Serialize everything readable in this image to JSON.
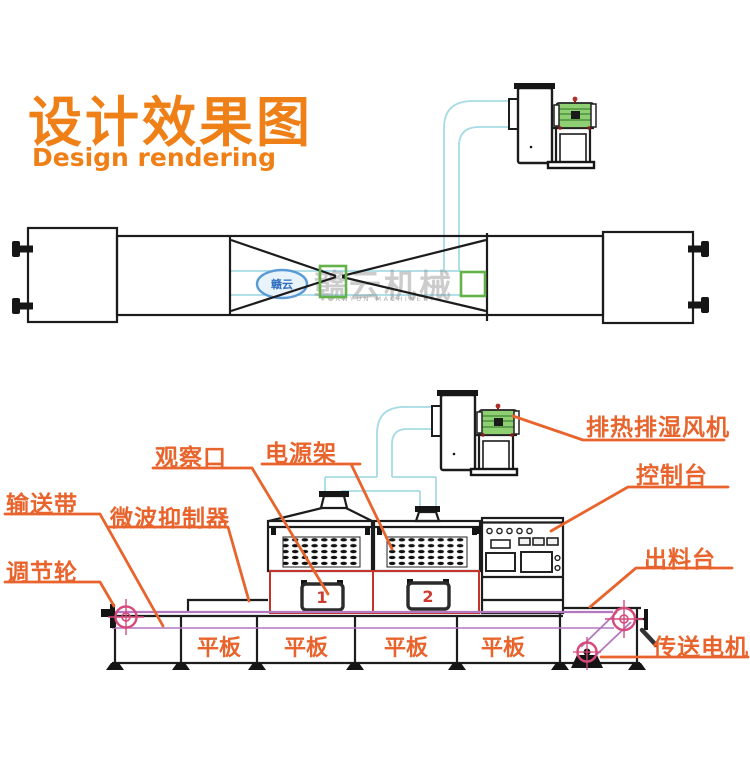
{
  "header": {
    "title": "设计效果图",
    "subtitle": "Design rendering"
  },
  "watermark": {
    "logo_short": "赣云",
    "brand_cn": "赣云机械",
    "brand_en": "GANYUN MACHINERY"
  },
  "callouts": {
    "observation_port": "观察口",
    "power_rack": "电源架",
    "conveyor_belt": "输送带",
    "microwave_suppressor": "微波抑制器",
    "adjust_wheel": "调节轮",
    "exhaust_fan": "排热排湿风机",
    "control_console": "控制台",
    "discharge_table": "出料台",
    "conveyor_motor": "传送电机"
  },
  "plates": [
    "平板",
    "平板",
    "平板",
    "平板"
  ],
  "windows": [
    "1",
    "2"
  ],
  "colors": {
    "title_orange": "#ef8018",
    "label_orange": "#e8642c",
    "duct_cyan": "#a6dbe6",
    "belt_purple": "#b478c0",
    "wheel_pink": "#d6497a",
    "frame_red": "#c5342c",
    "number_red": "#cd3a2e",
    "motor_green": "#8ecf72",
    "suppressor_green": "#63b24a",
    "line_black": "#1c1c1c"
  }
}
